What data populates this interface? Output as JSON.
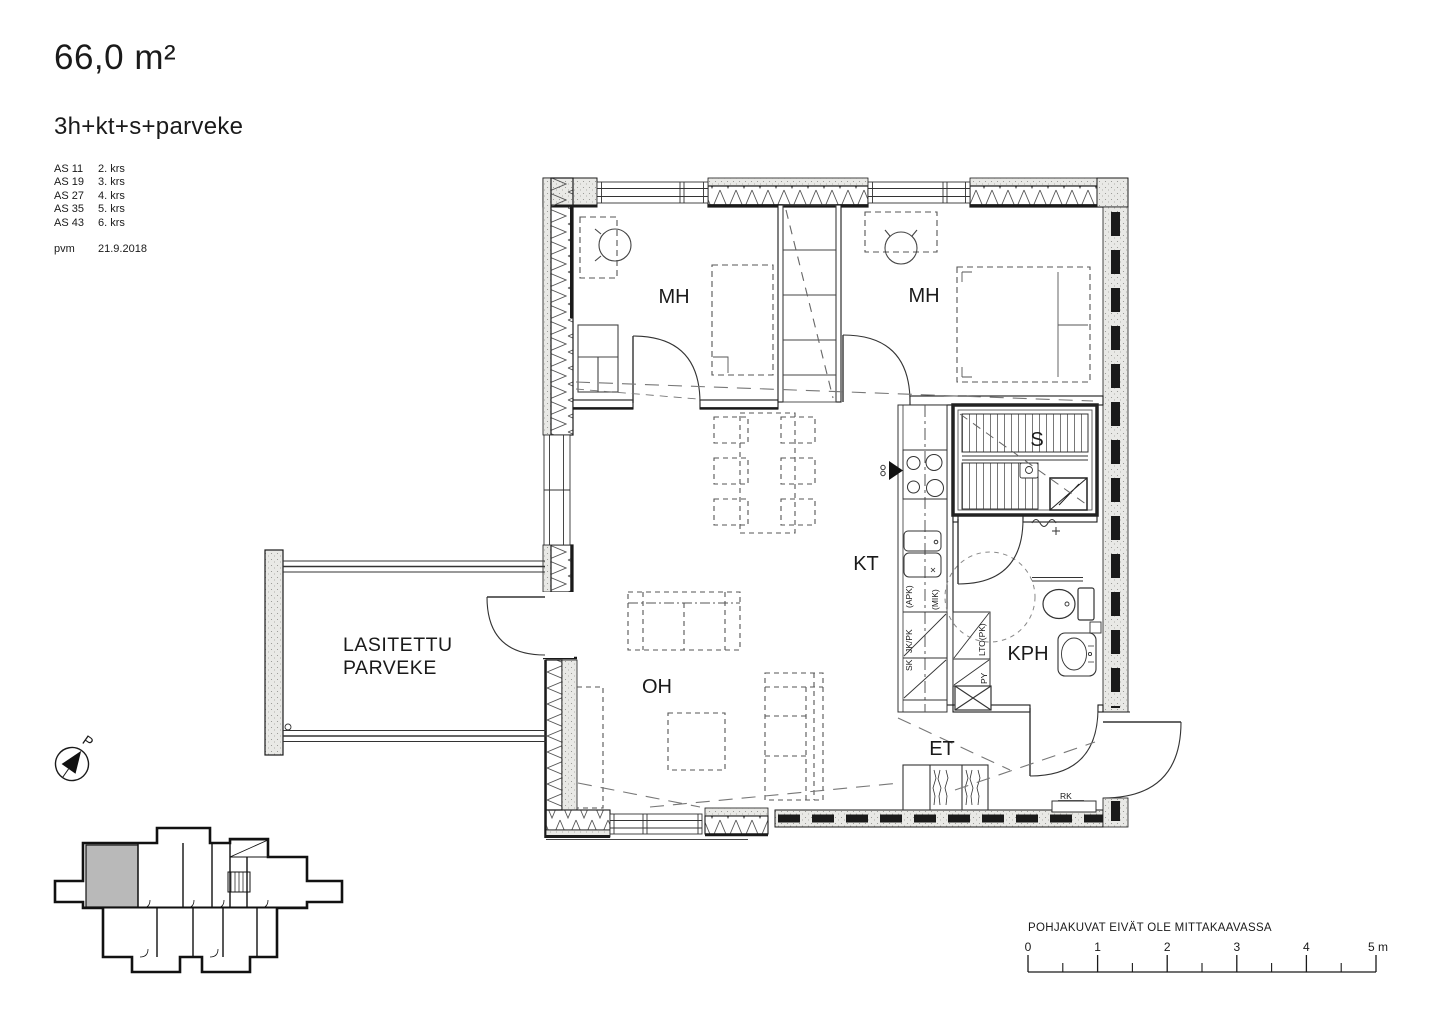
{
  "header": {
    "area": "66,0 m²",
    "layout": "3h+kt+s+parveke",
    "apartments": [
      {
        "id": "AS 11",
        "floor": "2. krs"
      },
      {
        "id": "AS 19",
        "floor": "3. krs"
      },
      {
        "id": "AS 27",
        "floor": "4. krs"
      },
      {
        "id": "AS 35",
        "floor": "5. krs"
      },
      {
        "id": "AS 43",
        "floor": "6. krs"
      }
    ],
    "date_label": "pvm",
    "date_value": "21.9.2018"
  },
  "plan": {
    "rooms": {
      "bedroom1": "MH",
      "bedroom2": "MH",
      "sauna": "S",
      "kitchen": "KT",
      "bathroom": "KPH",
      "living_room": "OH",
      "entry": "ET",
      "balcony_line1": "LASITETTU",
      "balcony_line2": "PARVEKE"
    },
    "labels": {
      "apk": "(APK)",
      "mik": "(MIK)",
      "jk_pk": "JK/PK",
      "sk": "SK",
      "lto_pk": "LTO(PK)",
      "py": "PY",
      "rk": "RK"
    }
  },
  "compass": {
    "north_label": "P"
  },
  "footer": {
    "disclaimer": "POHJAKUVAT EIVÄT OLE MITTAKAAVASSA",
    "scale_ticks": [
      "0",
      "1",
      "2",
      "3",
      "4",
      "5 m"
    ]
  }
}
